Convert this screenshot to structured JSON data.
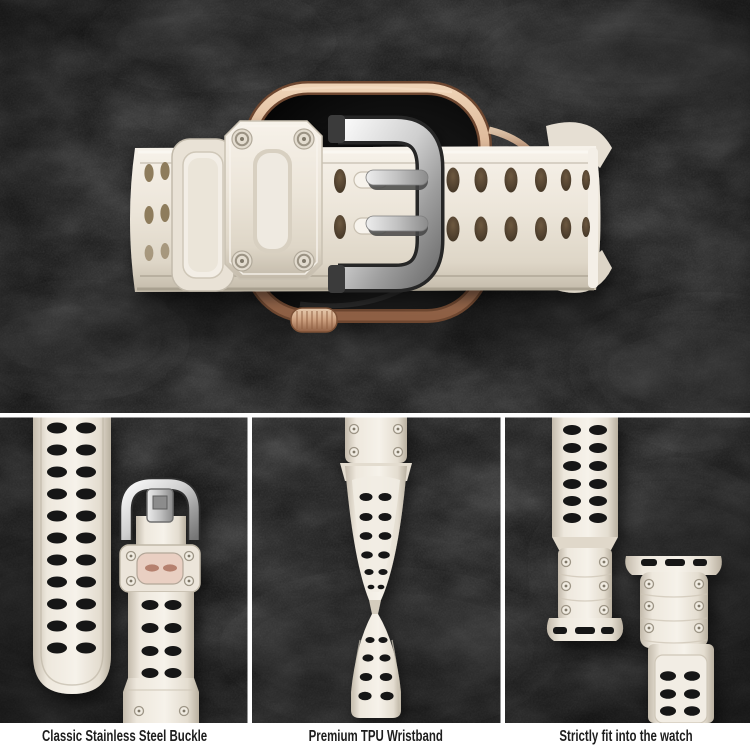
{
  "features": [
    {
      "label": "Classic Stainless Steel Buckle"
    },
    {
      "label": "Premium TPU Wristband"
    },
    {
      "label": "Strictly fit into the watch"
    }
  ],
  "colors": {
    "background_slate": "#121212",
    "band_white": "#ece5d9",
    "band_shadow": "#c6bdae",
    "buckle_silver": "#c9c9c9",
    "watch_case_gold": "#cc9f7e",
    "screen_black": "#0a0a0a",
    "strap_hole_black": "#161616",
    "strap_hole_brown": "#5e4b35",
    "divider_white": "#ffffff",
    "caption_bg": "#ffffff",
    "caption_text": "#1d1d1d"
  }
}
